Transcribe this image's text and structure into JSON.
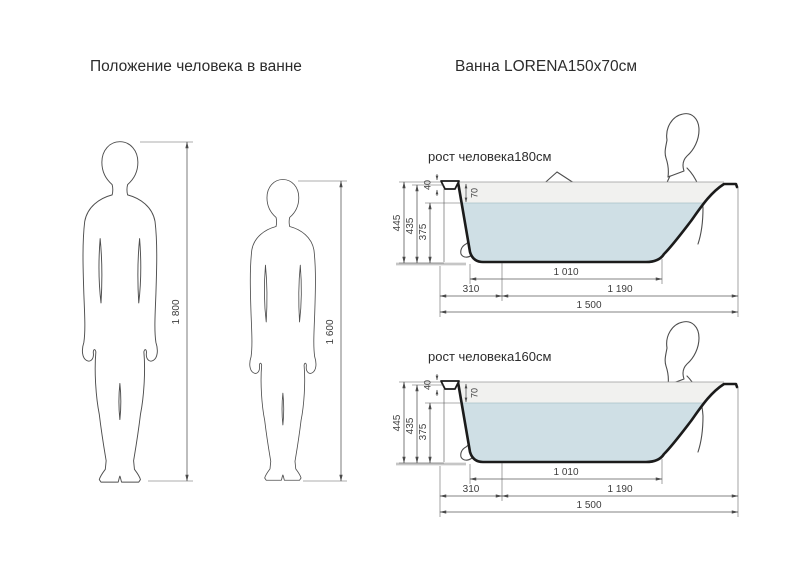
{
  "titles": {
    "left": "Положение человека в ванне",
    "right": "Ванна  LORENA150x70см"
  },
  "figures": {
    "tall": {
      "height": "1 800"
    },
    "short": {
      "height": "1 600"
    }
  },
  "tubs": {
    "first": {
      "label": "рост человека180см"
    },
    "second": {
      "label": "рост человека160см"
    },
    "dims": {
      "total_height": "445",
      "inner_height": "435",
      "water_depth": "375",
      "rim_height": "40",
      "rim_to_water": "70",
      "bottom_length": "1 010",
      "drain_offset": "310",
      "slope_length": "1 190",
      "total_length": "1 500"
    }
  },
  "colors": {
    "water": "#cfdfe5",
    "above_water": "#f1f1ef",
    "outline": "#1b1b1b",
    "figure_line": "#4d4d4d",
    "dim_line": "#5a5a5a",
    "dim_text": "#3d3d3d",
    "text": "#2c2c2c",
    "floor": "#c6c6c6"
  }
}
